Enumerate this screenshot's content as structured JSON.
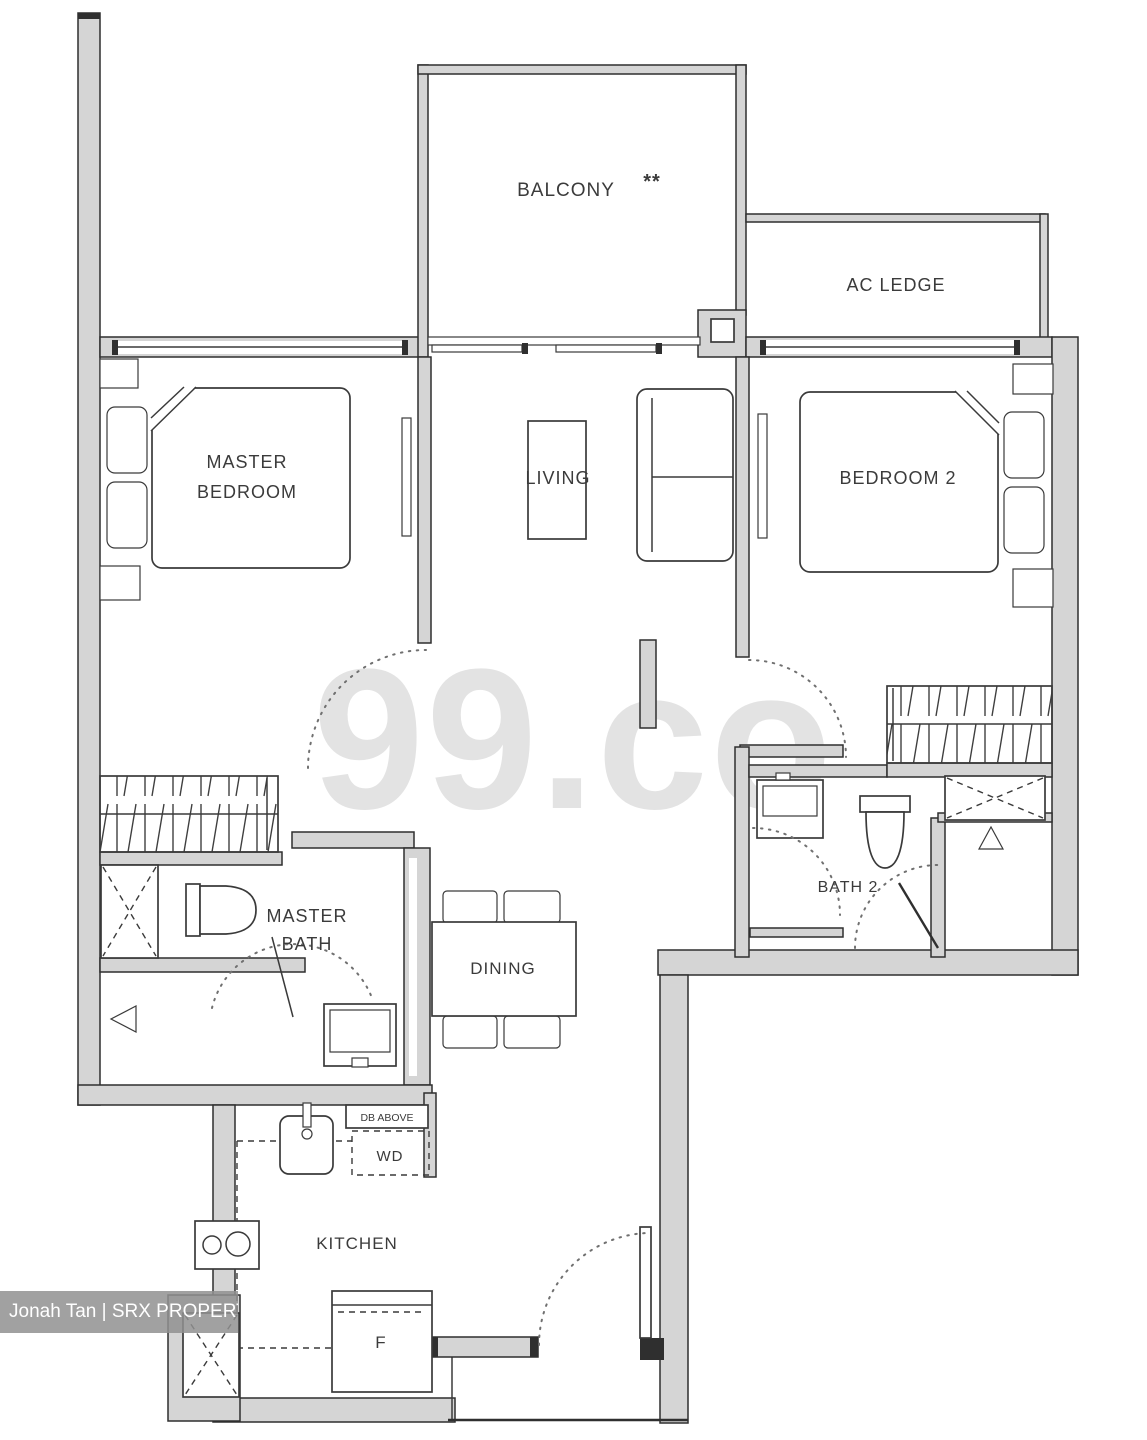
{
  "plan": {
    "rooms": {
      "balcony": "BALCONY",
      "balcony_note": "**",
      "ac_ledge": "AC LEDGE",
      "master_bedroom_line1": "MASTER",
      "master_bedroom_line2": "BEDROOM",
      "living": "LIVING",
      "bedroom_2": "BEDROOM 2",
      "master_bath_line1": "MASTER",
      "master_bath_line2": "BATH",
      "bath_2": "BATH 2",
      "dining": "DINING",
      "kitchen": "KITCHEN"
    },
    "fixtures": {
      "washer_dryer": "WD",
      "db_above": "DB ABOVE",
      "fridge": "F"
    }
  },
  "watermark": {
    "brand": "99.co"
  },
  "credit": {
    "text": "Jonah Tan | SRX PROPERTY"
  },
  "colors": {
    "wall_fill": "#d5d5d5",
    "line": "#2f2f2f",
    "watermark_gray": "#e3e3e3",
    "credit_band": "#8f8f8f",
    "credit_text": "#ffffff"
  }
}
